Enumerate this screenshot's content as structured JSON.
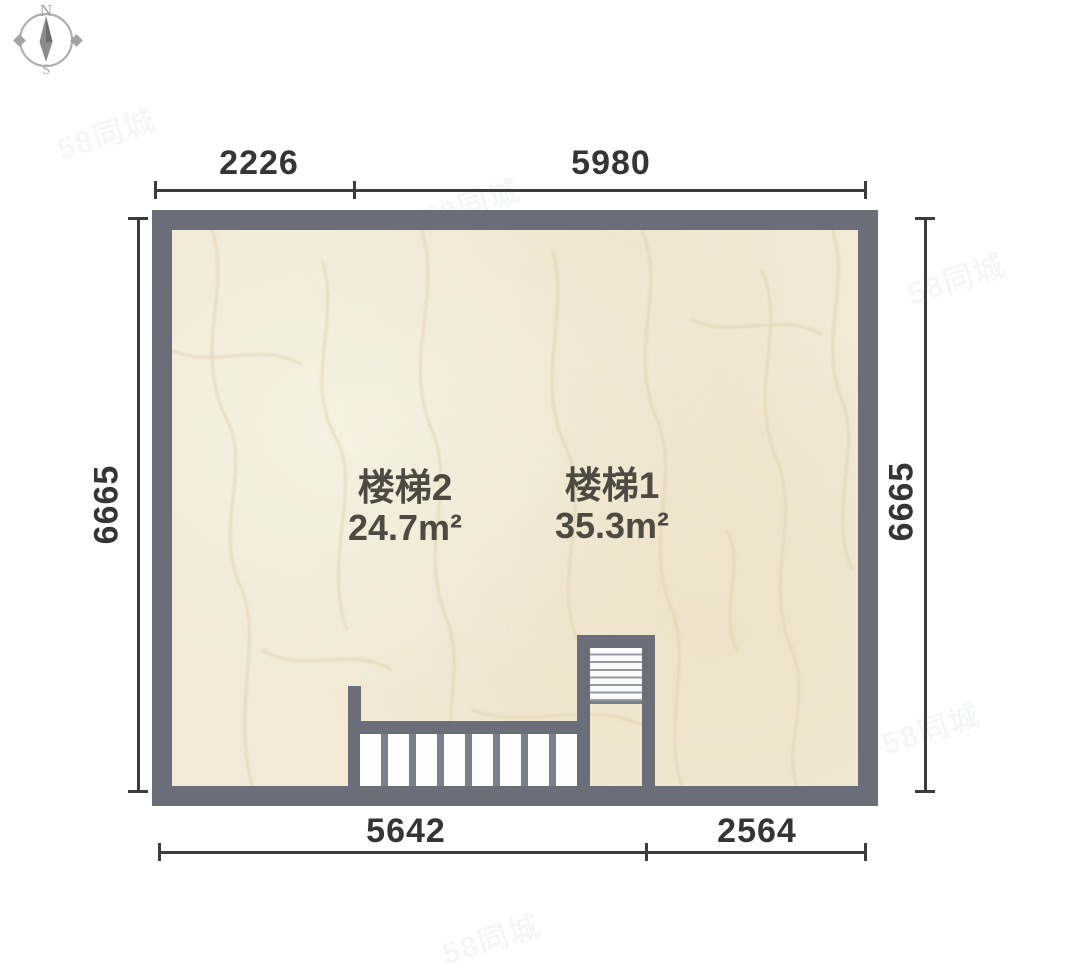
{
  "compass": {
    "north": "N",
    "south": "S"
  },
  "watermark": {
    "text": "58同城"
  },
  "plan": {
    "rooms": [
      {
        "name": "楼梯2",
        "area": "24.7m²"
      },
      {
        "name": "楼梯1",
        "area": "35.3m²"
      }
    ]
  },
  "dimensions": {
    "top": [
      {
        "label": "2226"
      },
      {
        "label": "5980"
      }
    ],
    "bottom": [
      {
        "label": "5642"
      },
      {
        "label": "2564"
      }
    ],
    "left": {
      "label": "6665"
    },
    "right": {
      "label": "6665"
    }
  },
  "colors": {
    "wall": "#6b6e78",
    "floor": "#f2ead6",
    "dimension_line": "#3c3c3c",
    "room_text": "#4f4a41",
    "tread_white": "#fcfcfc"
  }
}
